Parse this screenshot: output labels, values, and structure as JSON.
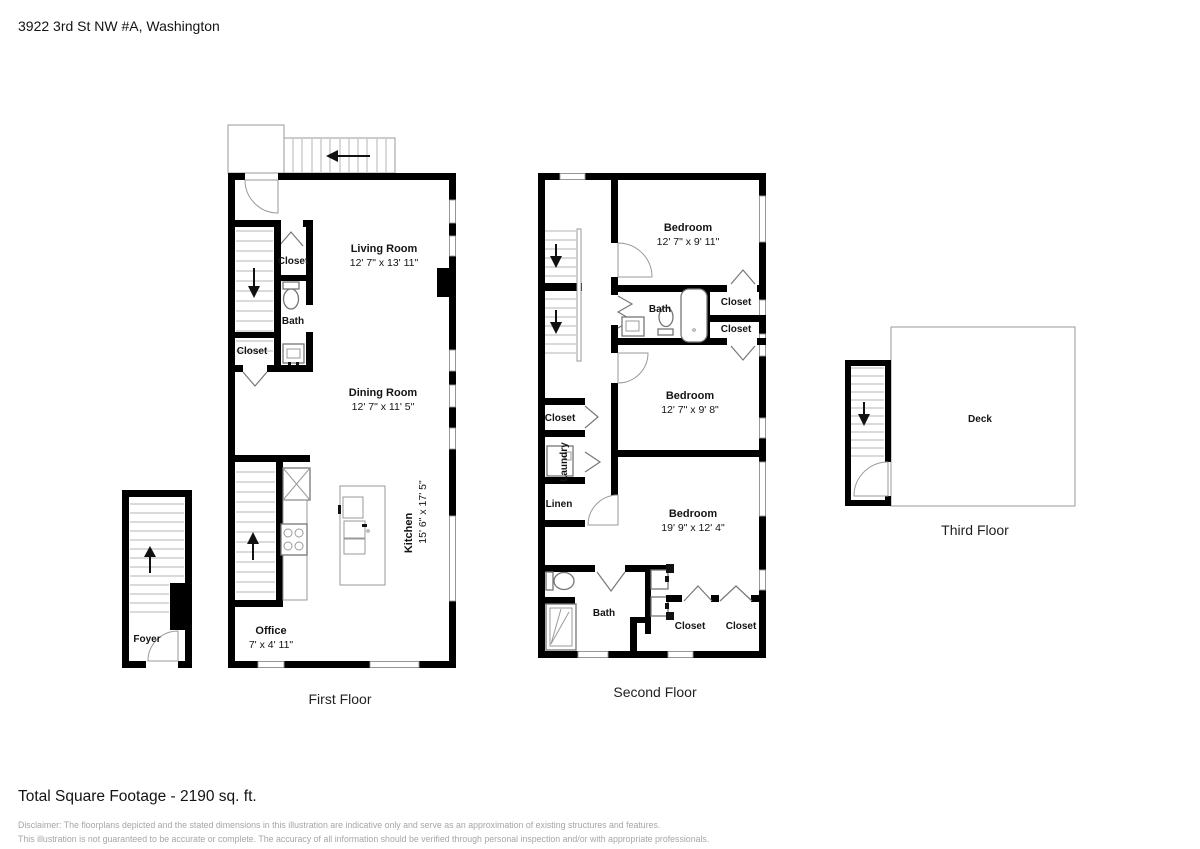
{
  "page": {
    "address": "3922 3rd St NW #A, Washington",
    "total_square_footage": "Total Square Footage - 2190 sq. ft.",
    "disclaimer_line1": "Disclaimer: The floorplans depicted and the stated dimensions in this illustration are indicative only and serve as an approximation of existing structures and features.",
    "disclaimer_line2": "This illustration is not guaranteed to be accurate or complete. The accuracy of all information should be verified through personal inspection and/or with appropriate professionals."
  },
  "floors": {
    "first": {
      "label": "First Floor",
      "rooms": {
        "living_room": {
          "name": "Living Room",
          "dims": "12' 7\" x 13' 11\""
        },
        "dining_room": {
          "name": "Dining Room",
          "dims": "12' 7\" x 11' 5\""
        },
        "kitchen": {
          "name": "Kitchen",
          "dims": "15' 6\" x 17' 5\""
        },
        "office": {
          "name": "Office",
          "dims": "7' x 4' 11\""
        },
        "bath": {
          "name": "Bath"
        },
        "closet_upper": {
          "name": "Closet"
        },
        "closet_lower": {
          "name": "Closet"
        },
        "foyer": {
          "name": "Foyer"
        }
      }
    },
    "second": {
      "label": "Second Floor",
      "rooms": {
        "bedroom_top": {
          "name": "Bedroom",
          "dims": "12' 7\" x 9' 11\""
        },
        "bedroom_middle": {
          "name": "Bedroom",
          "dims": "12' 7\" x 9' 8\""
        },
        "bedroom_bottom": {
          "name": "Bedroom",
          "dims": "19' 9\" x 12' 4\""
        },
        "bath_top": {
          "name": "Bath"
        },
        "bath_bottom": {
          "name": "Bath"
        },
        "closet_right_1": {
          "name": "Closet"
        },
        "closet_right_2": {
          "name": "Closet"
        },
        "closet_hall": {
          "name": "Closet"
        },
        "laundry": {
          "name": "Laundry"
        },
        "linen": {
          "name": "Linen"
        },
        "closet_bottom_1": {
          "name": "Closet"
        },
        "closet_bottom_2": {
          "name": "Closet"
        }
      }
    },
    "third": {
      "label": "Third Floor",
      "rooms": {
        "deck": {
          "name": "Deck"
        }
      }
    }
  }
}
